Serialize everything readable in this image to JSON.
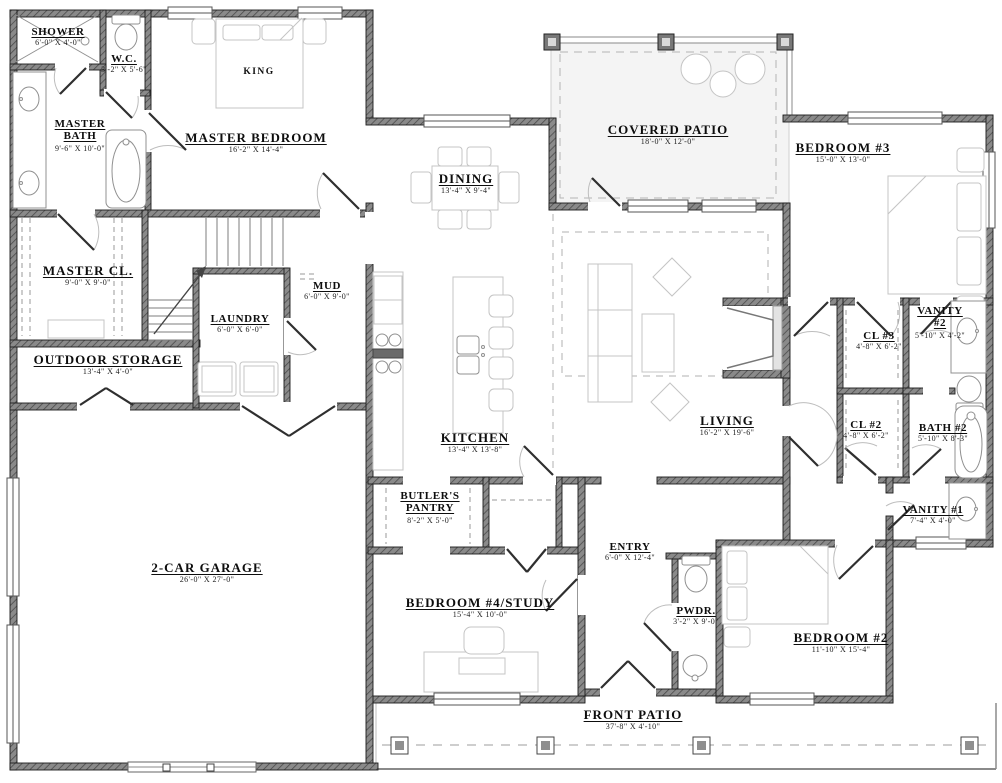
{
  "plan": {
    "title": "single-story house floor plan",
    "colors": {
      "wall": "#787878",
      "wall_outline": "#1c1c1c",
      "furniture_line": "#c4c4c4",
      "fixture_line": "#909090",
      "covered_patio_fill": "#f4f4f4",
      "text": "#111111"
    },
    "rooms": [
      {
        "id": "shower",
        "name": "SHOWER",
        "dims": "6'-0\" X 4'-0\""
      },
      {
        "id": "wc",
        "name": "W.C.",
        "dims": "3'-2\" X 5'-6\""
      },
      {
        "id": "master-bath",
        "name": "MASTER BATH",
        "dims": "9'-6\" X 10'-0\""
      },
      {
        "id": "master-bedroom",
        "name": "MASTER BEDROOM",
        "dims": "16'-2\" X 14'-4\""
      },
      {
        "id": "king-bed",
        "name": "KING",
        "dims": ""
      },
      {
        "id": "covered-patio",
        "name": "COVERED PATIO",
        "dims": "18'-0\" X 12'-0\""
      },
      {
        "id": "bedroom-3",
        "name": "BEDROOM #3",
        "dims": "15'-0\" X 13'-0\""
      },
      {
        "id": "dining",
        "name": "DINING",
        "dims": "13'-4\" X 9'-4\""
      },
      {
        "id": "master-cl",
        "name": "MASTER CL.",
        "dims": "9'-0\" X 9'-0\""
      },
      {
        "id": "mud",
        "name": "MUD",
        "dims": "6'-0\" X 9'-0\""
      },
      {
        "id": "laundry",
        "name": "LAUNDRY",
        "dims": "6'-0\" X 6'-0\""
      },
      {
        "id": "outdoor-storage",
        "name": "OUTDOOR STORAGE",
        "dims": "13'-4\" X 4'-0\""
      },
      {
        "id": "kitchen",
        "name": "KITCHEN",
        "dims": "13'-4\" X 13'-8\""
      },
      {
        "id": "living",
        "name": "LIVING",
        "dims": "16'-2\" X 19'-6\""
      },
      {
        "id": "cl-3",
        "name": "CL #3",
        "dims": "4'-8\" X 6'-2\""
      },
      {
        "id": "vanity-2",
        "name": "VANITY #2",
        "dims": "5'-10\" X 4'-2\""
      },
      {
        "id": "cl-2",
        "name": "CL #2",
        "dims": "4'-8\" X 6'-2\""
      },
      {
        "id": "bath-2",
        "name": "BATH #2",
        "dims": "5'-10\" X 8'-3\""
      },
      {
        "id": "vanity-1",
        "name": "VANITY #1",
        "dims": "7'-4\" X 4'-0\""
      },
      {
        "id": "garage",
        "name": "2-CAR GARAGE",
        "dims": "26'-0\" X 27'-0\""
      },
      {
        "id": "butlers-pantry",
        "name": "BUTLER'S PANTRY",
        "dims": "8'-2\" X 5'-0\""
      },
      {
        "id": "entry",
        "name": "ENTRY",
        "dims": "6'-0\" X 12'-4\""
      },
      {
        "id": "pwdr",
        "name": "PWDR.",
        "dims": "3'-2\" X 9'-0\""
      },
      {
        "id": "bedroom-4",
        "name": "BEDROOM #4/STUDY",
        "dims": "15'-4\" X 10'-0\""
      },
      {
        "id": "bedroom-2",
        "name": "BEDROOM #2",
        "dims": "11'-10\" X 15'-4\""
      },
      {
        "id": "front-patio",
        "name": "FRONT PATIO",
        "dims": "37'-8\" X 4'-10\""
      }
    ]
  }
}
